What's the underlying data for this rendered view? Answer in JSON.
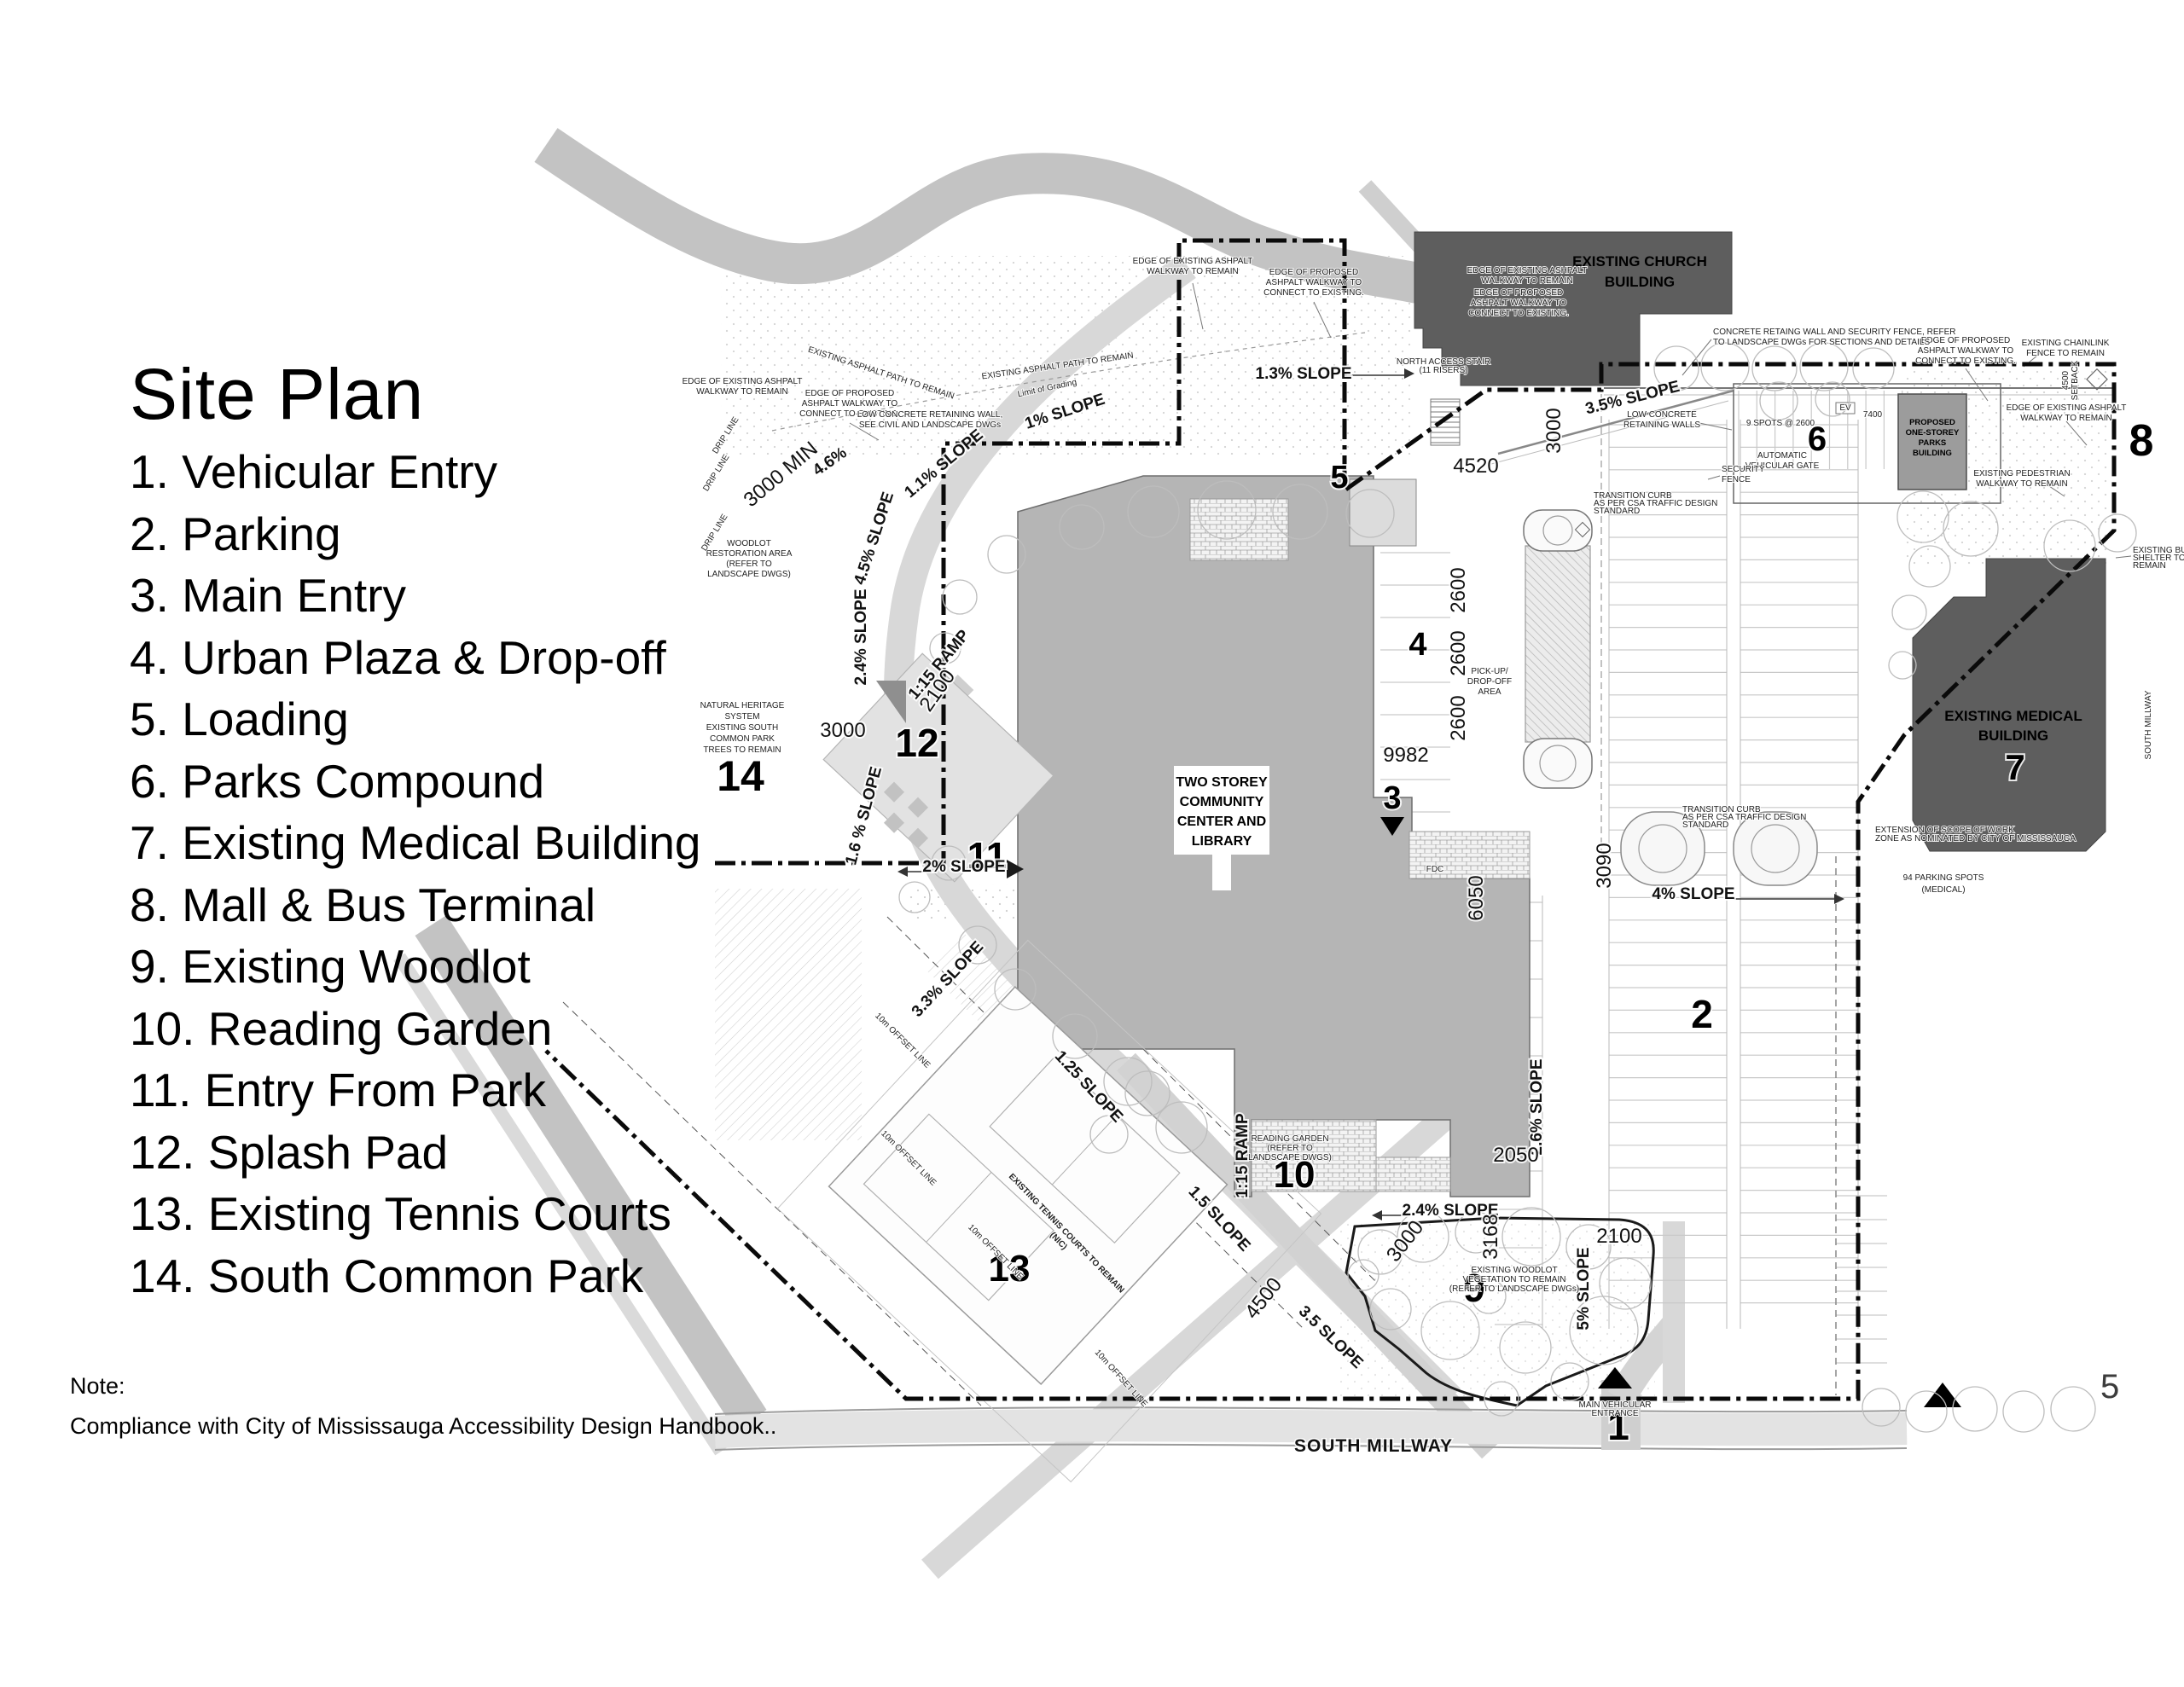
{
  "legend": {
    "title": "Site Plan",
    "items": [
      "1. Vehicular Entry",
      "2. Parking",
      "3. Main Entry",
      "4. Urban Plaza & Drop-off",
      "5. Loading",
      "6. Parks Compound",
      "7. Existing Medical Building",
      "8. Mall & Bus Terminal",
      "9. Existing Woodlot",
      "10. Reading Garden",
      "11. Entry From Park",
      "12. Splash Pad",
      "13. Existing Tennis Courts",
      "14. South Common Park"
    ],
    "note_label": "Note:",
    "note_text": "Compliance with City of Mississauga Accessibility Design Handbook.."
  },
  "page_number": "5",
  "plan": {
    "markers": {
      "n1": "1",
      "n2": "2",
      "n3": "3",
      "n4": "4",
      "n5": "5",
      "n6": "6",
      "n7": "7",
      "n8": "8",
      "n9": "9",
      "n10": "10",
      "n11": "11",
      "n12": "12",
      "n13": "13",
      "n14": "14"
    },
    "buildings": {
      "church": [
        "EXISTING CHURCH",
        "BUILDING"
      ],
      "community": [
        "TWO STOREY",
        "COMMUNITY",
        "CENTER AND",
        "LIBRARY"
      ],
      "medical": [
        "EXISTING MEDICAL",
        "BUILDING"
      ],
      "parks": [
        "PROPOSED",
        "ONE-STOREY",
        "PARKS",
        "BUILDING"
      ]
    },
    "streets": {
      "south_millway": "SOUTH MILLWAY",
      "south_millway_side": "SOUTH MILLWAY"
    },
    "slopes": {
      "top_13": "1.3% SLOPE",
      "ne_35": "3.5% SLOPE",
      "nw_1": "1% SLOPE",
      "nw_11": "1.1% SLOPE",
      "nw_46": "4.6%",
      "w_45": "4.5% SLOPE",
      "w_24": "2.4% SLOPE",
      "w_16": "1.6 % SLOPE",
      "w_2": "2% SLOPE",
      "w_33": "3.3% SLOPE",
      "t_125": "1.25 SLOPE",
      "t_15": "1.5 SLOPE",
      "ramp": "1:15 RAMP",
      "s_24": "2.4% SLOPE",
      "s_26": "2.6% SLOPE",
      "s_5": "5% SLOPE",
      "e_4": "4% SLOPE",
      "s_35": "3.5 SLOPE"
    },
    "dims": {
      "d4520": "4520",
      "d3000": "3000",
      "d2600": "2600",
      "d9982": "9982",
      "d6050": "6050",
      "d3090": "3090",
      "d2050": "2050",
      "d2100": "2100",
      "d3168": "3168",
      "d3000b": "3000",
      "d4500": "4500",
      "d2100b": "2100",
      "d3000c": "3000",
      "d3000min": "3000 MIN",
      "d7400": "7400"
    },
    "notes": {
      "edge_existing": [
        "EDGE OF EXISTING ASHPALT",
        "WALKWAY TO REMAIN"
      ],
      "edge_proposed": [
        "EDGE OF PROPOSED",
        "ASHPALT WALKWAY TO",
        "CONNECT TO EXISTING."
      ],
      "concrete_fence": [
        "CONCRETE RETAING WALL AND SECURITY FENCE, REFER",
        "TO LANDSCAPE DWGs FOR SECTIONS AND DETAILS"
      ],
      "low_walls": [
        "LOW CONCRETE",
        "RETAINING WALLS"
      ],
      "low_wall_civil": [
        "LOW CONCRETE RETAINING WALL,",
        "SEE CIVIL AND LANDSCAPE DWGs"
      ],
      "auto_gate": [
        "AUTOMATIC",
        "VEHICULAR GATE"
      ],
      "security_fence": [
        "SECURITY",
        "FENCE"
      ],
      "spots": "9 SPOTS @ 2600",
      "chainlink": [
        "EXISTING CHAINLINK",
        "FENCE TO REMAIN"
      ],
      "pedestrian": [
        "EXISTING PEDESTRIAN",
        "WALKWAY TO REMAIN"
      ],
      "setback": [
        "4500",
        "SETBACK"
      ],
      "natural_heritage": [
        "NATURAL HERITAGE",
        "SYSTEM",
        "EXISTING SOUTH",
        "COMMON PARK",
        "TREES TO REMAIN"
      ],
      "woodlot_restoration": [
        "WOODLOT",
        "RESTORATION AREA",
        "(REFER TO",
        "LANDSCAPE DWGS)"
      ],
      "reading_garden": [
        "READING GARDEN",
        "(REFER TO",
        "LANDSCAPE DWGS)"
      ],
      "existing_woodlot": [
        "EXISTING WOODLOT",
        "VEGETATION TO REMAIN",
        "(REFER TO LANDSCAPE DWGs)"
      ],
      "parking_spots": [
        "94 PARKING SPOTS",
        "(MEDICAL)"
      ],
      "tennis": [
        "EXISTING TENNIS COURTS TO REMAIN",
        "(NIC)"
      ],
      "limit_grading": "Limit of Grading",
      "drip_line": "DRIP LINE",
      "pickup": [
        "PICK-UP/",
        "DROP-OFF",
        "AREA"
      ],
      "fdc": "FDC",
      "offset_line": "10m OFFSET LINE",
      "asphalt_path": "EXISTING ASPHALT PATH TO REMAIN",
      "north_stair": [
        "NORTH ACCESS STAIR",
        "(11 RISERS)"
      ],
      "transition_curb": [
        "TRANSITION CURB",
        "AS PER CSA TRAFFIC DESIGN",
        "STANDARD"
      ],
      "scope_of_work": [
        "EXTENSION OF SCOPE OF WORK",
        "ZONE AS NOMINATED BY CITY OF MISSISSAUGA"
      ],
      "bus_shelter": [
        "EXISTING BUS",
        "SHELTER TO",
        "REMAIN"
      ],
      "main_entrance": [
        "MAIN VEHICULAR",
        "ENTRANCE"
      ],
      "ev": "EV"
    },
    "colors": {
      "building_dark": "#5e5e5e",
      "building_mid": "#b5b5b5",
      "building_parks": "#9c9c9c",
      "road": "#c3c3c3",
      "path": "#d8d8d8",
      "boundary": "#000000"
    }
  }
}
